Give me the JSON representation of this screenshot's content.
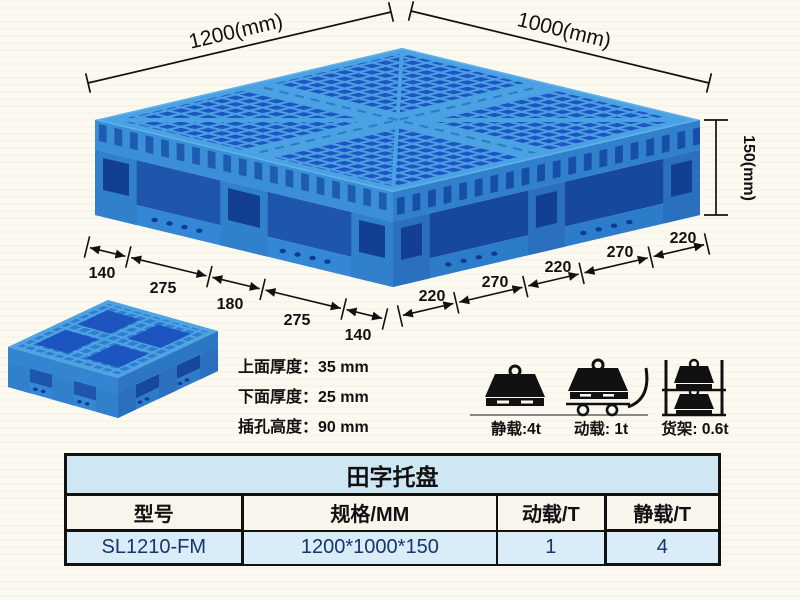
{
  "diagram": {
    "length_label": "1200(mm)",
    "width_label": "1000(mm)",
    "height_label": "150(mm)",
    "left_chain": [
      "140",
      "275",
      "180",
      "275",
      "140"
    ],
    "right_chain": [
      "220",
      "270",
      "220",
      "270",
      "220"
    ],
    "thickness_notes": [
      "上面厚度：35 mm",
      "下面厚度：25 mm",
      "插孔高度：90 mm"
    ]
  },
  "loads": [
    {
      "icon": "static-load-weight",
      "label": "静载:4t"
    },
    {
      "icon": "dynamic-load-hand-truck",
      "label": "动载: 1t"
    },
    {
      "icon": "rack-load-shelving",
      "label": "货架: 0.6t"
    }
  ],
  "table": {
    "title": "田字托盘",
    "headers": [
      "型号",
      "规格/MM",
      "动载/T",
      "静载/T"
    ],
    "rows": [
      [
        "SL1210-FM",
        "1200*1000*150",
        "1",
        "4"
      ]
    ]
  },
  "colors": {
    "pallet_light_blue": "#4b9fe0",
    "pallet_mid_blue": "#2e7fd0",
    "pallet_dark_blue": "#1d55c6",
    "table_title_bg": "#cfe6f3",
    "table_header_bg": "#f8f5ec",
    "table_row_bg": "#d9ecf8",
    "page_bg": "#fbf9f0",
    "line_color": "#111111"
  }
}
